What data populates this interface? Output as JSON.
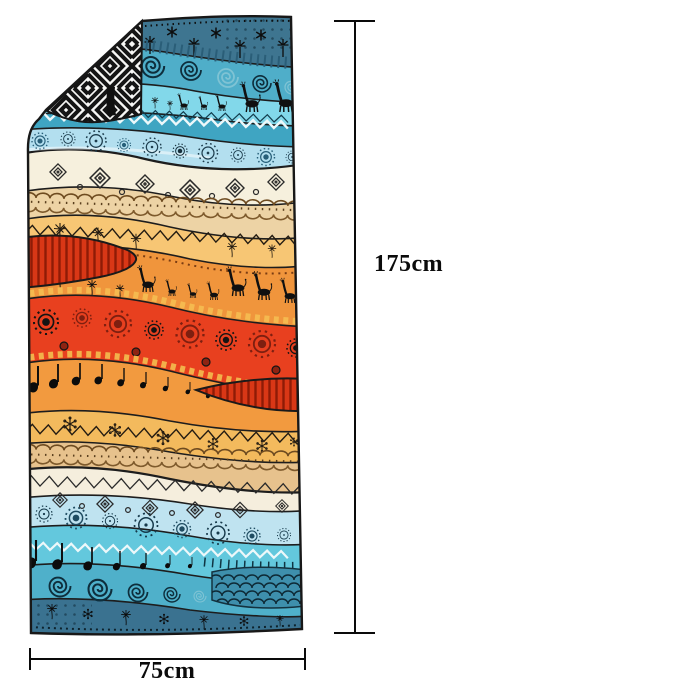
{
  "labels": {
    "height": "175cm",
    "width": "75cm"
  },
  "towel": {
    "orientation": "vertical rectangle, top-left corner folded over showing reverse side",
    "back_pattern": "black-white geometric concentric diamonds",
    "motifs": [
      "giraffes",
      "spirals",
      "mandala-suns",
      "zigzags",
      "diamonds",
      "dandelions",
      "music-note-birds",
      "star-flowers",
      "braids",
      "scale-fans"
    ],
    "palette": {
      "dark_teal": "#3E7590",
      "spiral_teal": "#4FAEC9",
      "light_cyan": "#82D8EA",
      "zigzag_teal": "#3FA5C2",
      "pale_blue": "#B3DFEF",
      "cream": "#F6F0DD",
      "tan": "#EDD3A5",
      "light_orange": "#F7C674",
      "orange": "#F0953C",
      "red": "#E8401F",
      "dark_red": "#8E2312",
      "amber": "#F3BA5D",
      "bottom_cream": "#F5EEDD",
      "bottom_pale_blue": "#BFE3F0",
      "bottom_cyan": "#63C8DD",
      "bottom_teal": "#4FB0CA",
      "bottom_dark_teal": "#3A7290",
      "fold_black": "#151515",
      "fold_white": "#F7F7F5",
      "outline": "#1a1a1a"
    }
  }
}
